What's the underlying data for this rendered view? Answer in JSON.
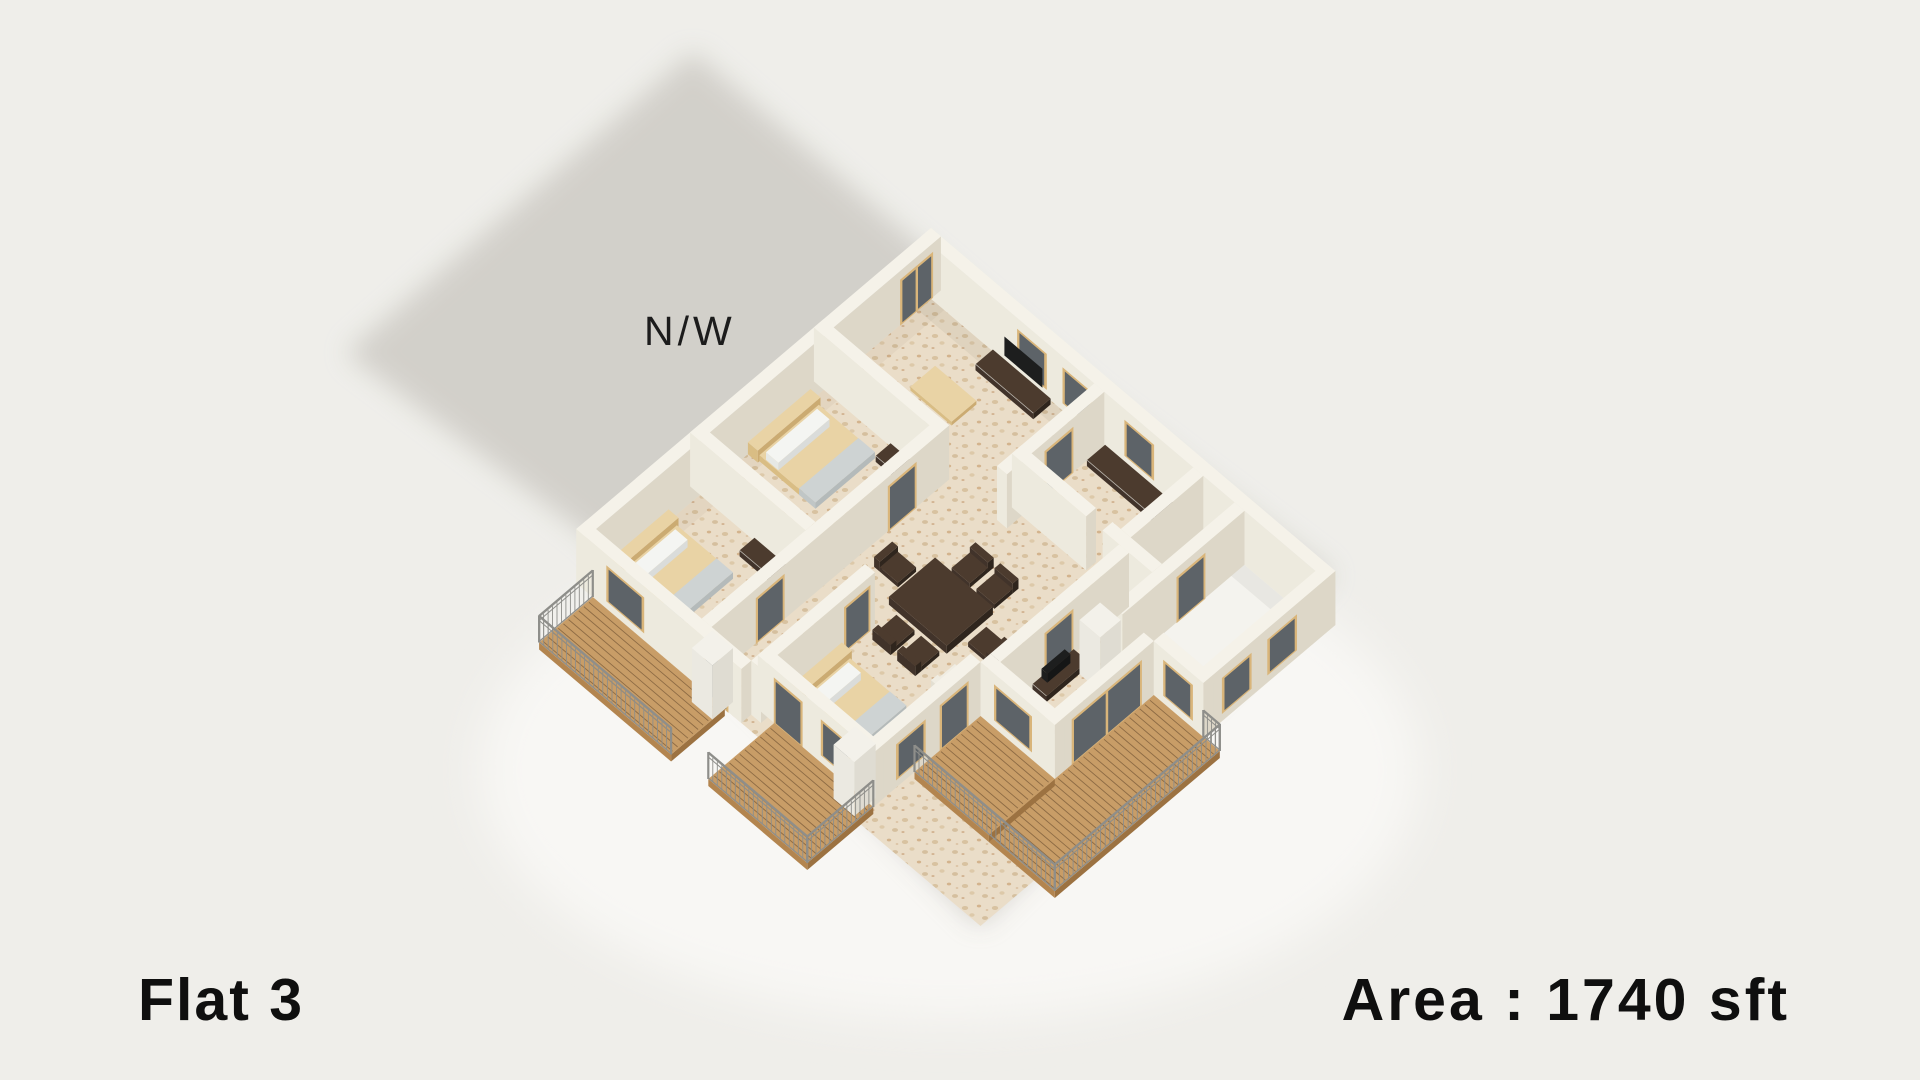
{
  "page": {
    "width": 1920,
    "height": 1080,
    "background": "#efeeea"
  },
  "labels": {
    "compass": "N/W",
    "flat_name": "Flat 3",
    "area": "Area : 1740 sft"
  },
  "scene": {
    "kind": "isometric-3d-floorplan-render",
    "shadow_direction": "cast toward upper-left",
    "features": "three bedrooms with beds, living room with sofa and TV console, dining table with six chairs, white-floor utility rooms, three wooden balcony decks with railings"
  },
  "palette": {
    "bg": "#efeeea",
    "shadow": "#d0cec8",
    "glow": "#f8f7f4",
    "wallTop": "#f5f2e9",
    "wallLight": "#edeade",
    "wallDark": "#ddd7c8",
    "floorBase": "#eaddc8",
    "floorWhite": "#f4f3ee",
    "deck": "#c89d67",
    "deckGap": "#8d6b44",
    "deckSide": "#b3854f",
    "deckSide2": "#9c7241",
    "rail": "#8e8e8a",
    "doorWood": "#d9b57a",
    "glass": "#5d6368",
    "woodLight": "#e9d3a5",
    "woodLightSide": "#d9bd84",
    "woodLightDark": "#cbab72",
    "dark1": "#41332a",
    "dark2": "#2f251d",
    "darkTop": "#4c3b2e",
    "mattress": "#ced3d3",
    "mattressSide": "#c0c6c6",
    "mattressSide2": "#b4baba",
    "blanket": "#d9dad6",
    "pillow": "#f4f5f2",
    "sofa": "#f0ede3",
    "sofaSide": "#e3dfd2",
    "sofaSide2": "#d6d2c3",
    "pillarTop": "#f3f1ea",
    "pillarLight": "#ebe9e1",
    "pillarDark": "#dfdcd2",
    "tv": "#1d1e1e",
    "text": "#0f0f0f"
  }
}
